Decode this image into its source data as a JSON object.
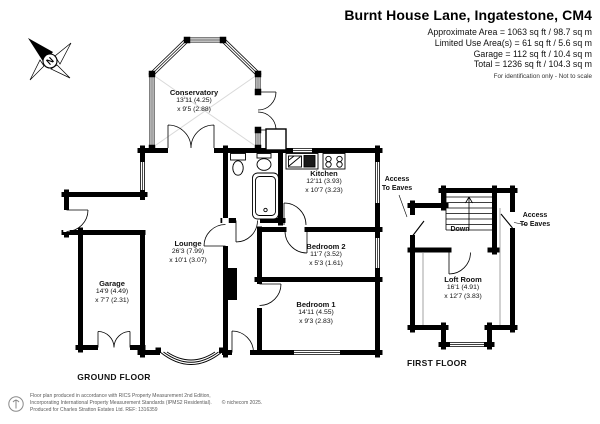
{
  "header": {
    "title": "Burnt House Lane, Ingatestone, CM4",
    "area_lines": [
      "Approximate Area = 1063 sq ft / 98.7 sq m",
      "Limited Use Area(s) = 61 sq ft / 5.6 sq m",
      "Garage = 112 sq ft / 10.4 sq m",
      "Total = 1236 sq ft / 104.3 sq m"
    ],
    "disclaimer": "For identification only - Not to scale"
  },
  "rooms": {
    "conservatory": {
      "name": "Conservatory",
      "dim1": "13'11 (4.25)",
      "dim2": "x 9'5 (2.88)"
    },
    "kitchen": {
      "name": "Kitchen",
      "dim1": "12'11 (3.93)",
      "dim2": "x 10'7 (3.23)"
    },
    "lounge": {
      "name": "Lounge",
      "dim1": "26'3 (7.99)",
      "dim2": "x 10'1 (3.07)"
    },
    "garage": {
      "name": "Garage",
      "dim1": "14'9 (4.49)",
      "dim2": "x 7'7 (2.31)"
    },
    "bedroom2": {
      "name": "Bedroom 2",
      "dim1": "11'7 (3.52)",
      "dim2": "x 5'3 (1.61)"
    },
    "bedroom1": {
      "name": "Bedroom 1",
      "dim1": "14'11 (4.55)",
      "dim2": "x 9'3 (2.83)"
    },
    "loft": {
      "name": "Loft Room",
      "dim1": "16'1 (4.91)",
      "dim2": "x 12'7 (3.83)"
    }
  },
  "labels": {
    "ground_floor": "GROUND FLOOR",
    "first_floor": "FIRST FLOOR",
    "down": "Down",
    "access_eaves": {
      "line1": "Access",
      "line2": "To Eaves"
    },
    "north": "N"
  },
  "footer": {
    "line1": "Floor plan produced in accordance with RICS Property Measurement 2nd Edition,",
    "line2": "Incorporating International Property Measurement Standards (IPMS2 Residential).",
    "copyright": "© nichecom 2025.",
    "line3": "Produced for Charles Stratton Estates Ltd.   REF: 1316359"
  },
  "colors": {
    "wall": "#000000",
    "background": "#ffffff",
    "glazing": "#d9d9d9",
    "footer_text": "#5a5a5a"
  }
}
